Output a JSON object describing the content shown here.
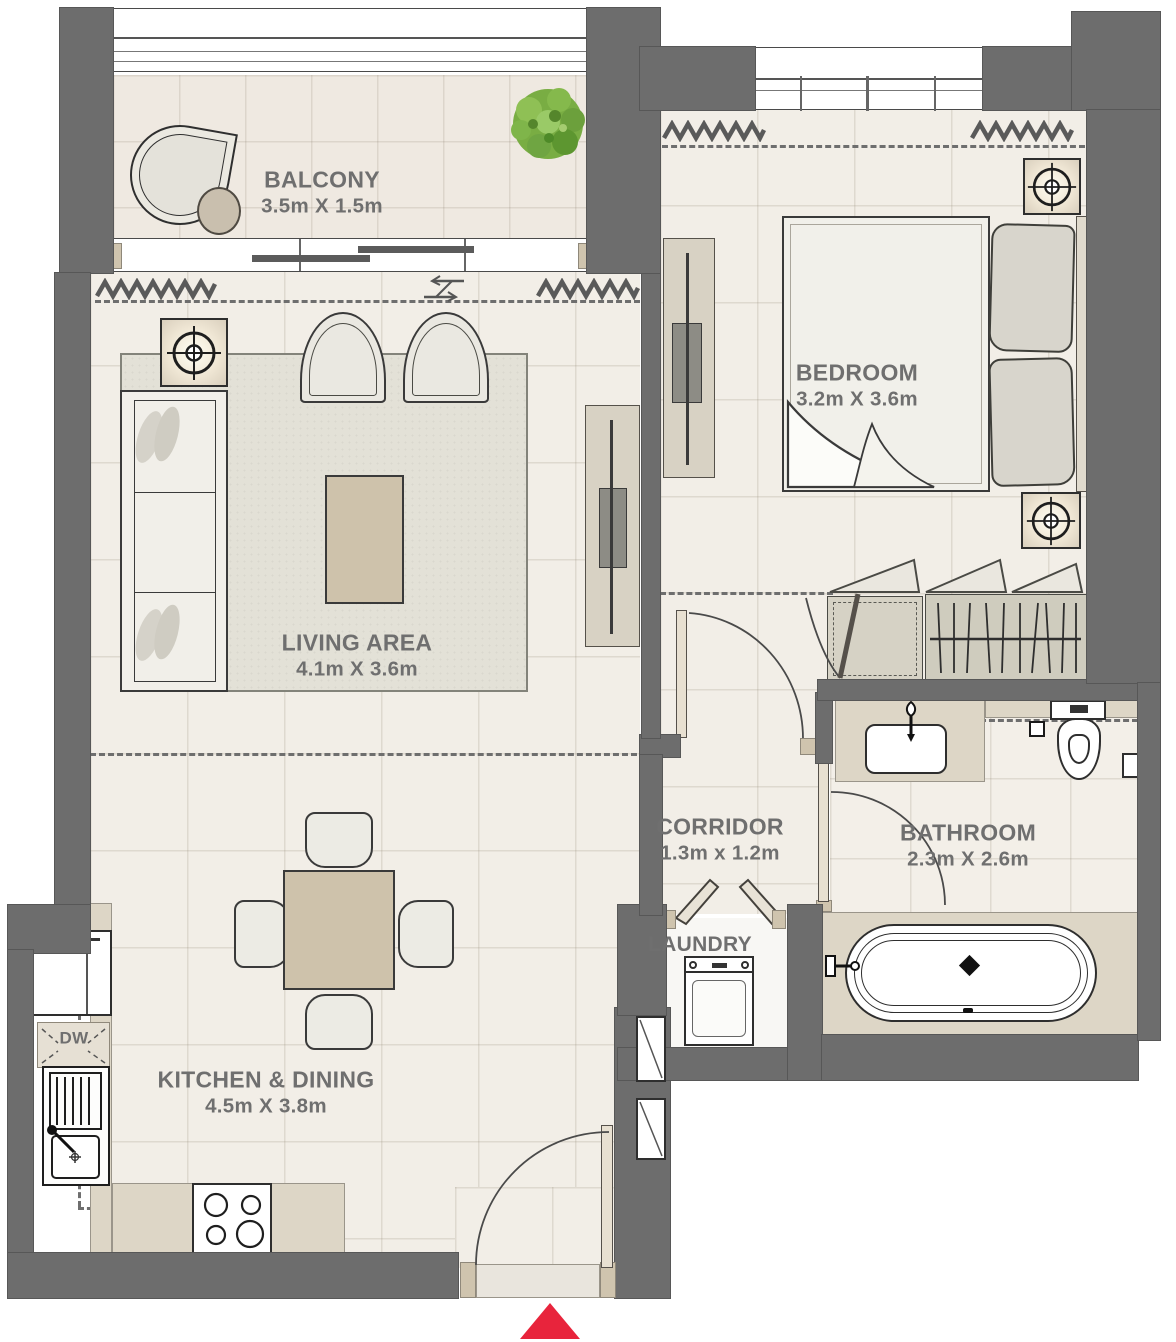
{
  "plan": {
    "type": "apartment-floor-plan",
    "rooms": [
      {
        "id": "balcony",
        "name": "BALCONY",
        "dims": "3.5m X 1.5m"
      },
      {
        "id": "bedroom",
        "name": "BEDROOM",
        "dims": "3.2m X 3.6m"
      },
      {
        "id": "living",
        "name": "LIVING AREA",
        "dims": "4.1m X 3.6m"
      },
      {
        "id": "corridor",
        "name": "CORRIDOR",
        "dims": "1.3m x 1.2m"
      },
      {
        "id": "bathroom",
        "name": "BATHROOM",
        "dims": "2.3m X 2.6m"
      },
      {
        "id": "laundry",
        "name": "LAUNDRY",
        "dims": ""
      },
      {
        "id": "kitchen",
        "name": "KITCHEN & DINING",
        "dims": "4.5m X 3.8m"
      }
    ],
    "labels": {
      "dishwasher": "DW"
    },
    "colors": {
      "wall": "#6d6d6d",
      "floor": "#f2eee7",
      "rug": "#e3e1d7",
      "cabinet": "#d8d2c4",
      "counter": "#ddd6c6",
      "table": "#cec2ab",
      "plant": "#76ac3d",
      "entrance_arrow": "#e8243c",
      "text": "#6f6f6f"
    },
    "entrance": {
      "marker": "red-up-arrow"
    }
  }
}
